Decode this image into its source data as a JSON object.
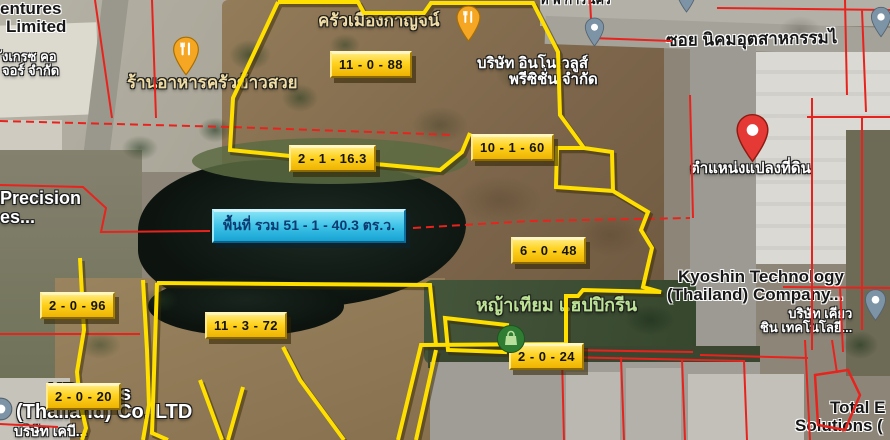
{
  "plot_labels": [
    "11 - 0 - 88",
    "2 - 1 - 16.3",
    "10 - 1 - 60",
    "6 - 0 - 48",
    "2 - 0 - 96",
    "11 - 3 - 72",
    "2 - 0 - 20",
    "2 - 0 - 24"
  ],
  "total_area_label": "พื้นที่ รวม 51 - 1 - 40.3 ตร.ว.",
  "places": {
    "ventures_line1": "entures",
    "ventures_line2": "Limited",
    "ventures_line3": "ังเกรซ คอ",
    "ventures_line4": "จอร์ จำกัด",
    "restaurant_khao_suay": "ร้านอาหารครัวข้าวสวย",
    "restaurant_mueang_kan": "ครัวเมืองกาญจน์",
    "innovalues_line1": "บริษัท อินโนเวลูส์",
    "innovalues_line2": "พรีซิชั่น จำกัด",
    "street": "ซอย นิคมอุตสาหกรรมไ",
    "pin_caption": "ตำแหน่งแปลงที่ดิน",
    "kyoshin_line1": "Kyoshin Technology",
    "kyoshin_line2": "(Thailand) Company...",
    "kyoshin_thai1": "บริษัท เคียว",
    "kyoshin_thai2": "ชิน เทคโนโลยี...",
    "grass_shop": "หญ้าเทียม แฮปปิกรีน",
    "precision_line1": "Precision",
    "precision_line2": "es...",
    "kb_line1a": "KB",
    "kb_line1b": "s",
    "kb_line2": "(Thailand) Co.,LTD",
    "kb_line3": "บริษัท เคบี...",
    "total_solutions_line1": "Total E",
    "total_solutions_line2": "Solutions (",
    "top_clipped": "ท พ การนคร"
  },
  "colors": {
    "plot_label_bg": "#FFD21E",
    "plot_label_text": "#141414",
    "total_label_bg": "#3FC3E8",
    "total_label_text": "#0B3B70",
    "boundary_yellow": "#FFDF00",
    "cadastral_red": "#E8231D",
    "pin_red": "#E53935",
    "pin_orange": "#F5A623",
    "pin_gray": "#7D94A6",
    "store_icon_green": "#2F7D32"
  }
}
